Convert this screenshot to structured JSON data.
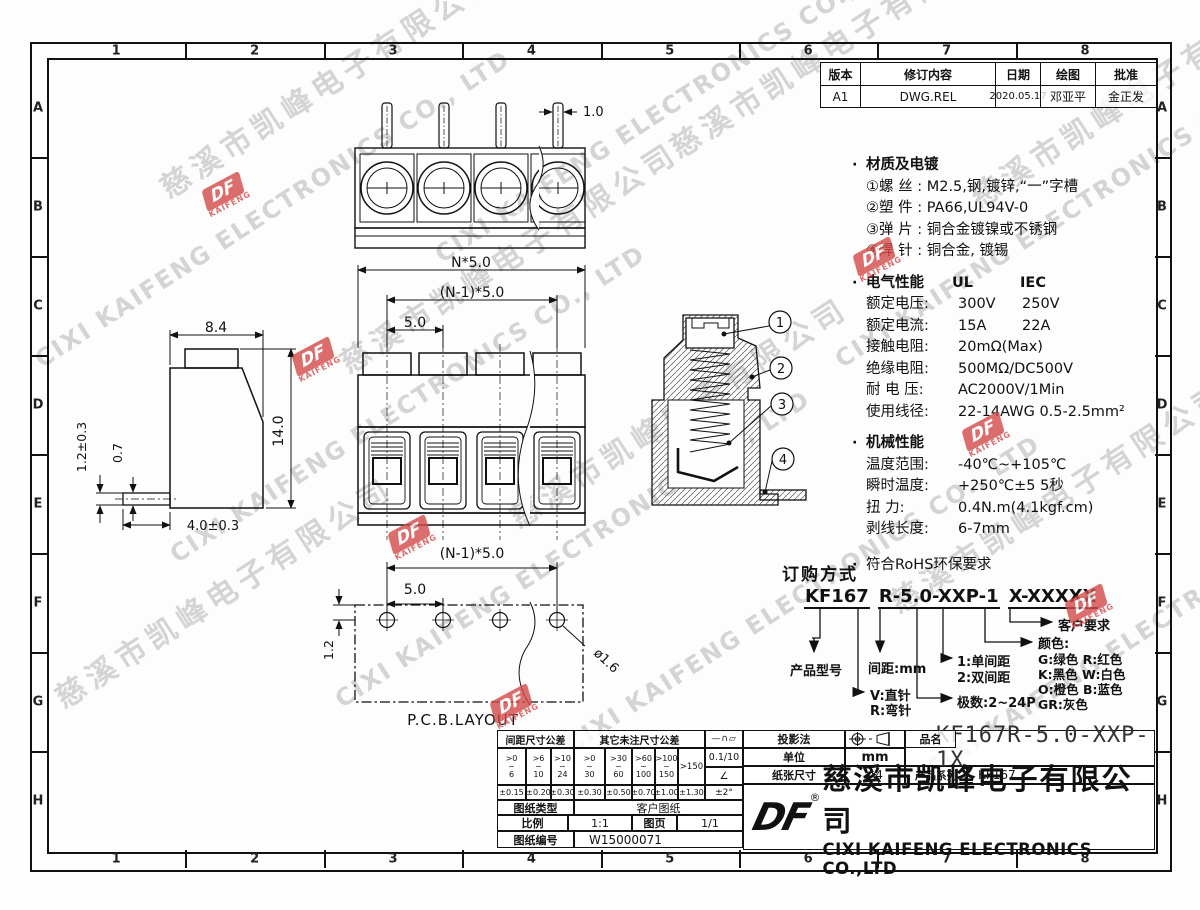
{
  "grid": {
    "cols": [
      "1",
      "2",
      "3",
      "4",
      "5",
      "6",
      "7",
      "8"
    ],
    "rows": [
      "A",
      "B",
      "C",
      "D",
      "E",
      "F",
      "G",
      "H"
    ]
  },
  "revision_table": {
    "headers": [
      "版本",
      "修订内容",
      "日期",
      "绘图",
      "批准"
    ],
    "row": {
      "version": "A1",
      "content": "DWG.REL",
      "date": "2020.05.17",
      "drawn": "邓亚平",
      "approved": "金正发"
    }
  },
  "bullet": "·",
  "specs": {
    "material": {
      "title": "材质及电镀",
      "lines": [
        "①螺 丝 : M2.5,钢,镀锌,“一”字槽",
        "②塑 件 : PA66,UL94V-0",
        "③弹 片 : 铜合金镀镍或不锈钢",
        "④焊 针 : 铜合金, 镀锡"
      ]
    },
    "electrical": {
      "title": "电气性能",
      "col1": "UL",
      "col2": "IEC",
      "rows": [
        {
          "label": "额定电压:",
          "c1": "300V",
          "c2": "250V"
        },
        {
          "label": "额定电流:",
          "c1": "15A",
          "c2": "22A"
        },
        {
          "label": "接触电阻:",
          "c1": "20mΩ(Max)",
          "c2": ""
        },
        {
          "label": "绝缘电阻:",
          "c1": "500MΩ/DC500V",
          "c2": ""
        },
        {
          "label": "耐 电 压:",
          "c1": "AC2000V/1Min",
          "c2": ""
        },
        {
          "label": "使用线径:",
          "c1": "22-14AWG  0.5-2.5mm²",
          "c2": ""
        }
      ]
    },
    "mechanical": {
      "title": "机械性能",
      "rows": [
        {
          "label": "温度范围:",
          "value": "-40℃~+105℃"
        },
        {
          "label": "瞬时温度:",
          "value": "+250℃±5  5秒"
        },
        {
          "label": "扭    力:",
          "value": "0.4N.m(4.1kgf.cm)"
        },
        {
          "label": "剥线长度:",
          "value": "6-7mm"
        }
      ]
    },
    "rohs": "符合RoHS环保要求"
  },
  "ordering": {
    "title": "订购方式",
    "code": {
      "p1": "KF167",
      "p2": "R-5.0-XXP-1",
      "p3": "X-XXXXX"
    },
    "labels": {
      "model": "产品型号",
      "pitch": "间距:mm",
      "v": "V:直针",
      "r": "R:弯针",
      "single": "1:单间距",
      "double": "2:双间距",
      "poles": "极数:2~24P",
      "color_title": "颜色:",
      "c1": "G:绿色  R:红色",
      "c2": "K:黑色  W:白色",
      "c3": "O:橙色  B:蓝色",
      "c4": "GR:灰色",
      "customer": "客户要求"
    }
  },
  "views": {
    "top": {
      "pin_width": "1.0"
    },
    "front": {
      "overall": "N*5.0",
      "centers": "(N-1)*5.0",
      "pitch": "5.0"
    },
    "side": {
      "width": "8.4",
      "height": "14.0",
      "pin_thickness": "1.2±0.3",
      "pin_web": "0.7",
      "pin_length": "4.0±0.3"
    },
    "section": {
      "balloons": [
        "1",
        "2",
        "3",
        "4"
      ]
    },
    "pcb": {
      "centers": "(N-1)*5.0",
      "pitch": "5.0",
      "edge": "1.2",
      "hole": "ø1.6",
      "label": "P.C.B.LAYOUT"
    }
  },
  "title_block": {
    "tol": {
      "h1": "间距尺寸公差",
      "h2": "其它未注尺寸公差",
      "r1": [
        {
          "a": ">0",
          "b": "~",
          "c": "6"
        },
        {
          "a": ">6",
          "b": "~",
          "c": "10"
        },
        {
          "a": ">10",
          "b": "~",
          "c": "24"
        }
      ],
      "t1": [
        "±0.15",
        "±0.20",
        "±0.30"
      ],
      "r2": [
        {
          "a": ">0",
          "b": "~",
          "c": "30"
        },
        {
          "a": ">30",
          "b": "~",
          "c": "60"
        },
        {
          "a": ">60",
          "b": "~",
          "c": "100"
        },
        {
          "a": ">100",
          "b": "~",
          "c": "150"
        }
      ],
      "r2last": ">150",
      "t2": [
        "±0.30",
        "±0.50",
        "±0.70",
        "±1.00",
        "±1.30"
      ],
      "flat": "0.1/10",
      "angle": "±2°"
    },
    "rows": {
      "type_label": "图纸类型",
      "type_value": "客户图纸",
      "scale_label": "比例",
      "scale_value": "1:1",
      "page_label": "图页",
      "page_value": "1/1",
      "no_label": "图纸编号",
      "no_value": "W15000071",
      "proj_label": "投影法",
      "unit_label": "单位",
      "unit_value": "mm",
      "paper_label": "纸张尺寸",
      "paper_value": "A4",
      "name_label": "品名",
      "name_value": "KF167R-5.0-XXP-1X",
      "series_label": "产品系列",
      "series_value": "KF167"
    },
    "company": {
      "reg": "®",
      "cn": "慈溪市凯峰电子有限公司",
      "en": "CIXI KAIFENG ELECTRONICS CO.,LTD"
    }
  },
  "watermark": {
    "cn": "慈溪市凯峰电子有限公司",
    "en": "CIXI KAIFENG ELECTRONICS CO., LTD"
  },
  "logo": {
    "mark": "DF",
    "name": "KAIFENG"
  }
}
